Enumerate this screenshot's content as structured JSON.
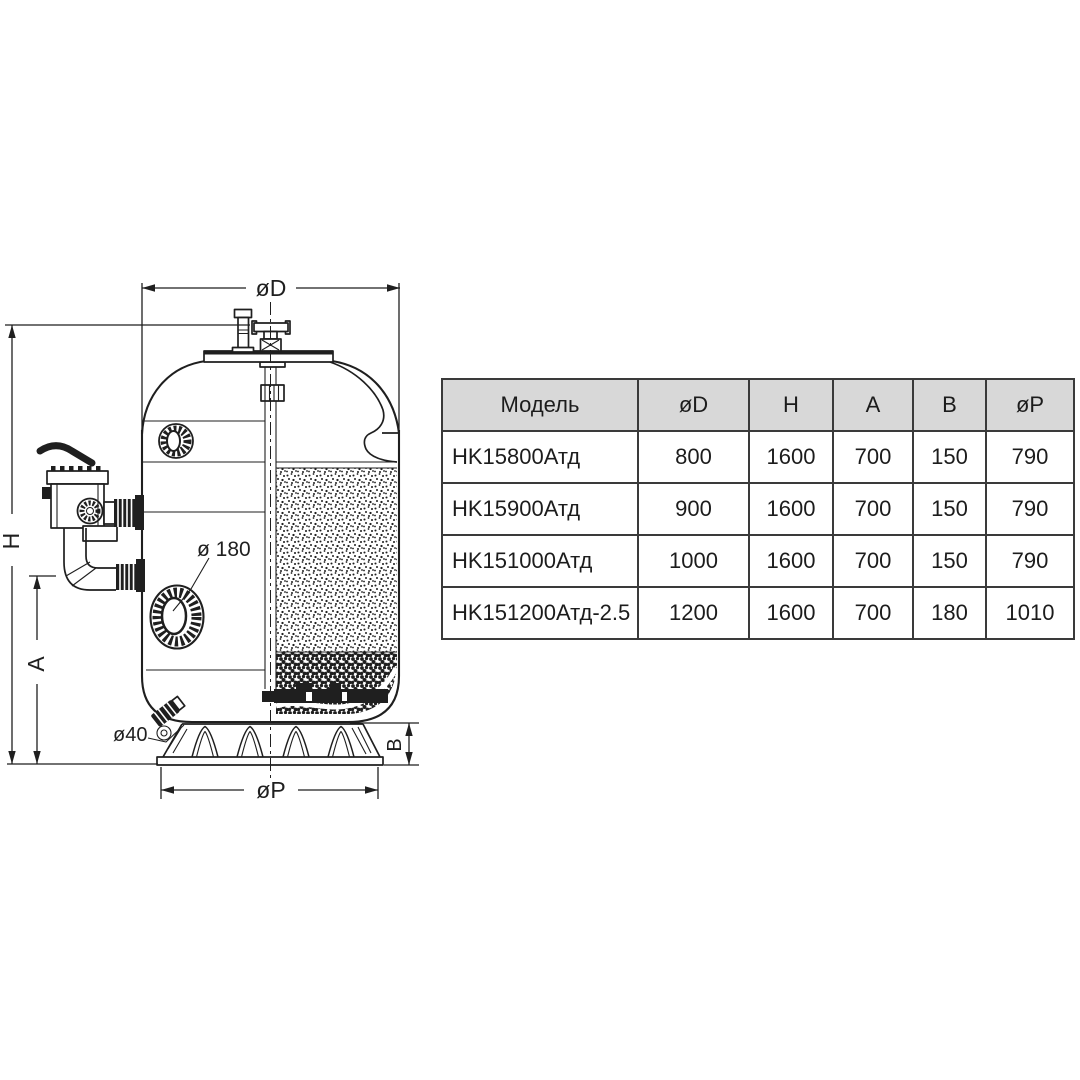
{
  "colors": {
    "line": "#1f1f1f",
    "table-border": "#3a3a3a",
    "header-bg": "#d8d8d8",
    "page-bg": "#ffffff",
    "text": "#1c1c1c"
  },
  "diagram": {
    "labels": {
      "d": "øD",
      "h": "H",
      "a": "A",
      "b": "B",
      "p": "øP",
      "viewport": "ø 180",
      "drain": "ø40"
    }
  },
  "table": {
    "columns": [
      "Модель",
      "øD",
      "H",
      "A",
      "B",
      "øP"
    ],
    "rows": [
      [
        "HK15800Атд",
        "800",
        "1600",
        "700",
        "150",
        "790"
      ],
      [
        "HK15900Атд",
        "900",
        "1600",
        "700",
        "150",
        "790"
      ],
      [
        "HK151000Атд",
        "1000",
        "1600",
        "700",
        "150",
        "790"
      ],
      [
        "HK151200Атд-2.5",
        "1200",
        "1600",
        "700",
        "180",
        "1010"
      ]
    ]
  }
}
